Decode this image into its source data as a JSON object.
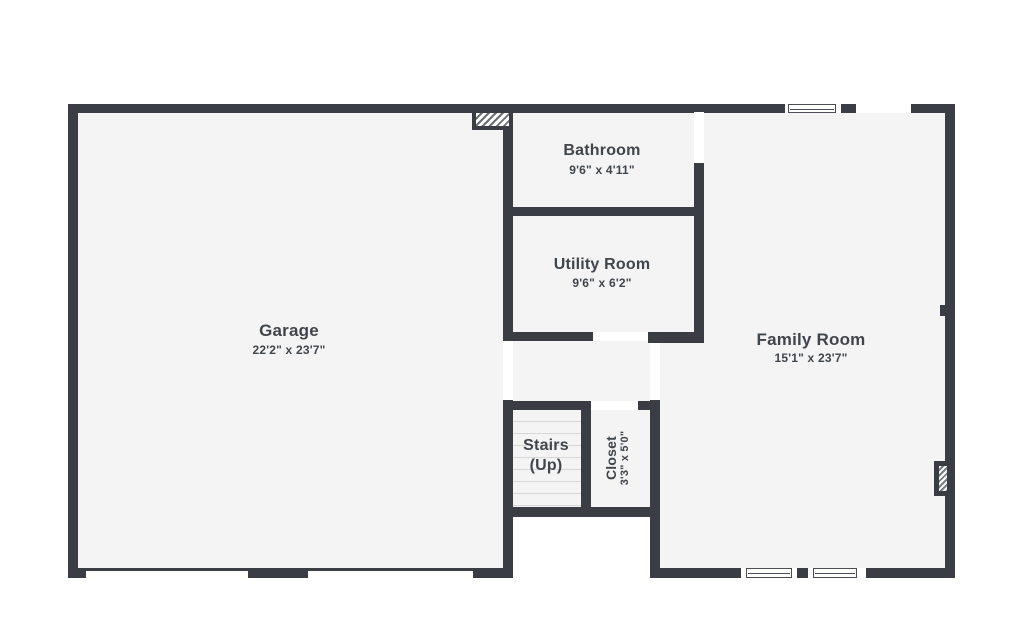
{
  "plan_title": "First floor plan",
  "colors": {
    "wall": "#3a3e44",
    "room_fill": "#f4f4f4",
    "background": "#ffffff",
    "text": "#40454b",
    "stair_tread": "#d7d7d7"
  },
  "rooms": [
    {
      "id": "garage",
      "label": "Garage",
      "dims": "22'2\" x 23'7\""
    },
    {
      "id": "bathroom",
      "label": "Bathroom",
      "dims": "9'6\" x 4'11\""
    },
    {
      "id": "utility",
      "label": "Utility Room",
      "dims": "9'6\" x 6'2\""
    },
    {
      "id": "family",
      "label": "Family Room",
      "dims": "15'1\" x 23'7\""
    },
    {
      "id": "stairs",
      "label": "Stairs",
      "label2": "(Up)"
    },
    {
      "id": "closet",
      "label": "Closet",
      "dims": "3'3\" x 5'0\""
    }
  ],
  "features": [
    "chimney-hatch-block",
    "fireplace-hatch-block",
    "double-garage-door-opening",
    "family-top-window",
    "family-bottom-windows",
    "door-openings"
  ]
}
